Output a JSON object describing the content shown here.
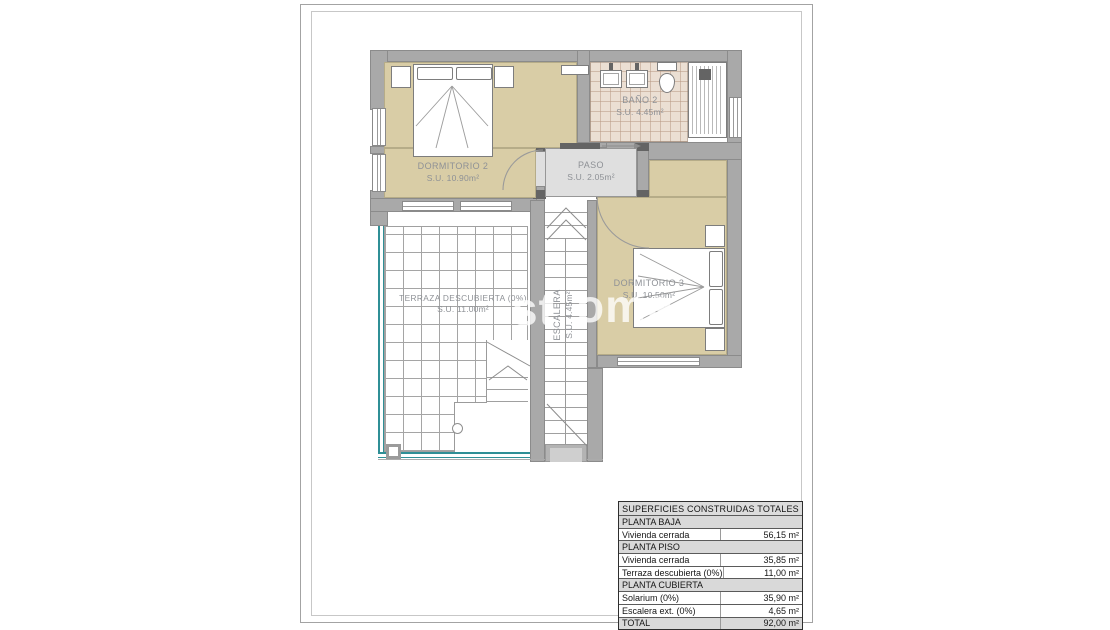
{
  "plan": {
    "rooms": {
      "dormitorio2": {
        "name": "DORMITORIO 2",
        "area": "S.U. 10.90m²"
      },
      "bano2": {
        "name": "BAÑO 2",
        "area": "S.U. 4.45m²"
      },
      "paso": {
        "name": "PASO",
        "area": "S.U. 2.05m²"
      },
      "dormitorio3": {
        "name": "DORMITORIO 3",
        "area": "S.U. 10.50m²"
      },
      "terraza": {
        "name": "TERRAZA DESCUBIERTA (0%)",
        "area": "S.U. 11.00m²"
      },
      "escalera": {
        "name": "ESCALERA",
        "area": "S.U. 4.45m²"
      }
    },
    "colors": {
      "wall_gray": "#a9a9a9",
      "room_beige": "#d9cda6",
      "bath_tile": "#ebdfd3",
      "paso_gray": "#dfdfdf",
      "balustrade_teal": "#2f8f96",
      "table_section_bg": "#d9d9d9"
    }
  },
  "watermark": {
    "fragments": [
      "st",
      "ome"
    ]
  },
  "table": {
    "title": "SUPERFICIES CONSTRUIDAS TOTALES",
    "rows": [
      {
        "type": "section",
        "label": "PLANTA BAJA"
      },
      {
        "type": "data",
        "label": "Vivienda cerrada",
        "value": "56,15 m²"
      },
      {
        "type": "section",
        "label": "PLANTA PISO"
      },
      {
        "type": "data",
        "label": "Vivienda cerrada",
        "value": "35,85 m²"
      },
      {
        "type": "data",
        "label": "Terraza descubierta (0%)",
        "value": "11,00 m²"
      },
      {
        "type": "section",
        "label": "PLANTA CUBIERTA"
      },
      {
        "type": "data",
        "label": "Solarium (0%)",
        "value": "35,90 m²"
      },
      {
        "type": "data",
        "label": "Escalera ext. (0%)",
        "value": "4,65 m²"
      },
      {
        "type": "total",
        "label": "TOTAL",
        "value": "92,00 m²"
      }
    ]
  }
}
